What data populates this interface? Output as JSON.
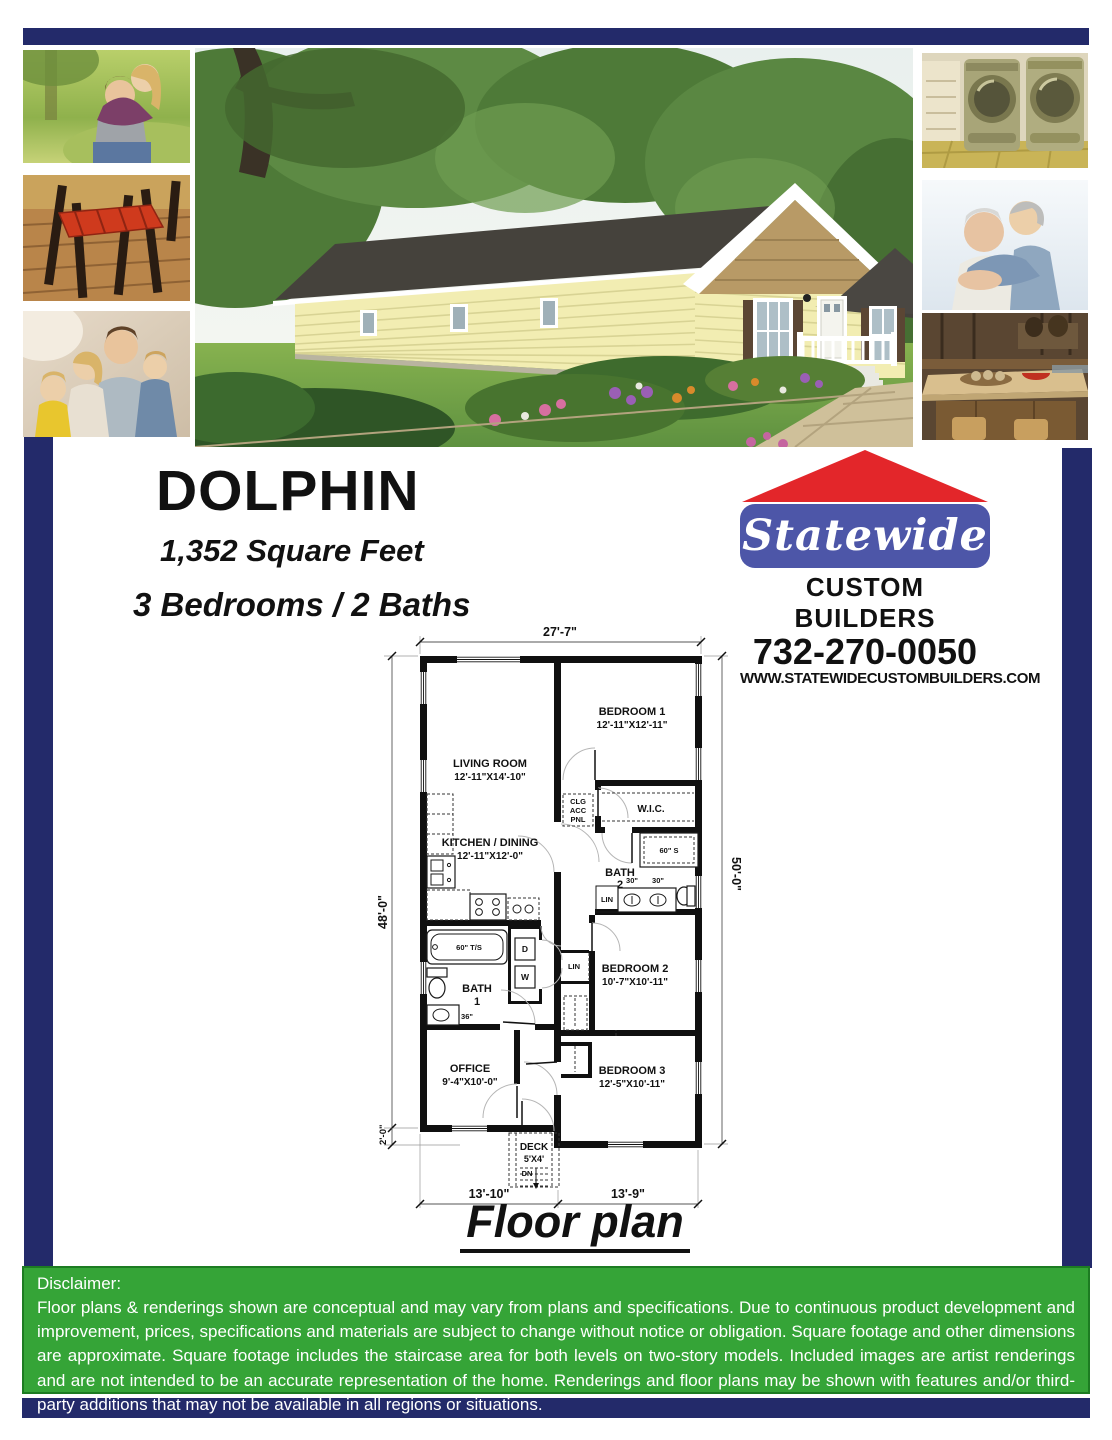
{
  "header": {
    "model_name": "DOLPHIN",
    "square_feet": "1,352 Square Feet",
    "beds_baths": "3 Bedrooms / 2 Baths"
  },
  "logo": {
    "brand": "Statewide",
    "subtitle": "CUSTOM BUILDERS",
    "phone": "732-270-0050",
    "website": "WWW.STATEWIDECUSTOMBUILDERS.COM"
  },
  "photos": {
    "left": [
      "young-couple-in-park",
      "wood-chairs-red-seats",
      "family-of-four"
    ],
    "center": "house-exterior-rendering",
    "right": [
      "washer-dryer-laundry",
      "senior-couple",
      "kitchen-island"
    ]
  },
  "floor_plan": {
    "caption": "Floor plan",
    "dims": {
      "top": "27'-7\"",
      "left": "48'-0\"",
      "right": "50'-0\"",
      "offset": "2'-0\"",
      "bottom_left": "13'-10\"",
      "bottom_right": "13'-9\""
    },
    "rooms": {
      "living": {
        "name": "LIVING ROOM",
        "size": "12'-11\"X14'-10\""
      },
      "bedroom1": {
        "name": "BEDROOM 1",
        "size": "12'-11\"X12'-11\""
      },
      "wic": {
        "name": "W.I.C."
      },
      "kitchen": {
        "name": "KITCHEN / DINING",
        "size": "12'-11\"X12'-0\""
      },
      "bath2": {
        "name": "BATH",
        "number": "2"
      },
      "bedroom2": {
        "name": "BEDROOM 2",
        "size": "10'-7\"X10'-11\""
      },
      "bath1": {
        "name": "BATH",
        "number": "1"
      },
      "office": {
        "name": "OFFICE",
        "size": "9'-4\"X10'-0\""
      },
      "bedroom3": {
        "name": "BEDROOM 3",
        "size": "12'-5\"X10'-11\""
      },
      "deck": {
        "name": "DECK",
        "size": "5'X4'",
        "down": "DN"
      }
    },
    "labels": {
      "clg": "CLG",
      "acc": "ACC",
      "pnl": "PNL",
      "shower": "60\" S",
      "vanity30_a": "30\"",
      "vanity30_b": "30\"",
      "lin_bath": "LIN",
      "lin_hall": "LIN",
      "tub": "60\" T/S",
      "dryer": "D",
      "washer": "W",
      "vanity36": "36\""
    }
  },
  "disclaimer": {
    "heading": "Disclaimer:",
    "body": "Floor plans & renderings shown are conceptual and may vary from plans and specifications. Due to continuous product development and improvement, prices, specifications and materials are subject to change without notice or obligation. Square footage and other dimensions are approximate. Square footage includes the staircase area for both levels on two-story models. Included images are artist renderings and are not intended to be an accurate representation of the home. Renderings and floor plans may be shown with features and/or third-party additions that may not be available in all regions or situations."
  },
  "colors": {
    "navy": "#232a6a",
    "green_band": "#35a437",
    "logo_red": "#e3262a",
    "logo_blue": "#4d56a8"
  }
}
